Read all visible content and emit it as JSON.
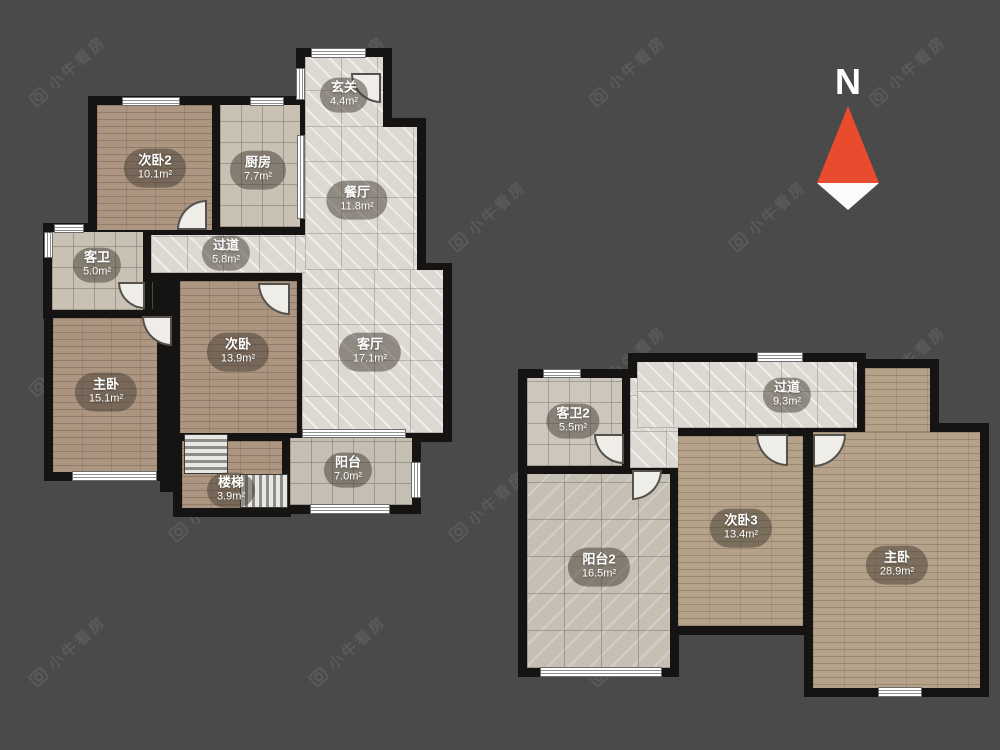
{
  "watermark": {
    "text": "小牛看房"
  },
  "compass": {
    "label": "N"
  },
  "plan_lower": {
    "rooms": {
      "entry": {
        "name": "玄关",
        "area": "4.4m²"
      },
      "bedroom2": {
        "name": "次卧2",
        "area": "10.1m²"
      },
      "kitchen": {
        "name": "厨房",
        "area": "7.7m²"
      },
      "dining": {
        "name": "餐厅",
        "area": "11.8m²"
      },
      "hallway": {
        "name": "过道",
        "area": "5.8m²"
      },
      "guest_bath": {
        "name": "客卫",
        "area": "5.0m²"
      },
      "bedroom": {
        "name": "次卧",
        "area": "13.9m²"
      },
      "living": {
        "name": "客厅",
        "area": "17.1m²"
      },
      "master": {
        "name": "主卧",
        "area": "15.1m²"
      },
      "balcony": {
        "name": "阳台",
        "area": "7.0m²"
      },
      "stairs": {
        "name": "楼梯",
        "area": "3.9m²"
      }
    }
  },
  "plan_upper": {
    "rooms": {
      "hallway2": {
        "name": "过道",
        "area": "9.3m²"
      },
      "guest_bath2": {
        "name": "客卫2",
        "area": "5.5m²"
      },
      "bedroom3": {
        "name": "次卧3",
        "area": "13.4m²"
      },
      "master2": {
        "name": "主卧",
        "area": "28.9m²"
      },
      "balcony2": {
        "name": "阳台2",
        "area": "16.5m²"
      }
    }
  }
}
